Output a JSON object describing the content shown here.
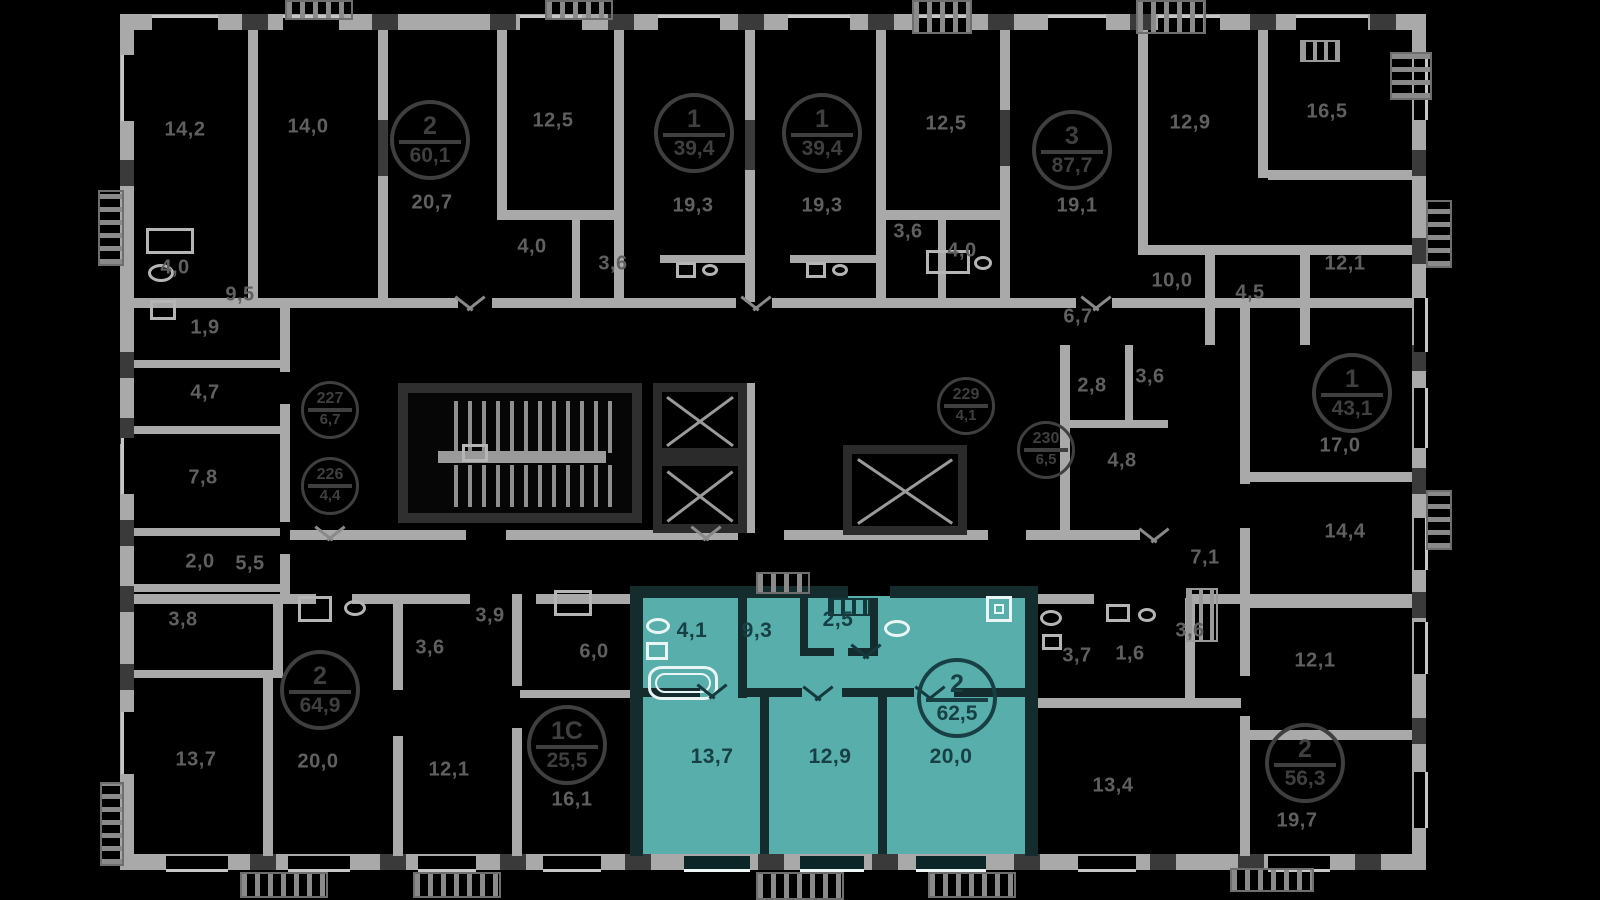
{
  "meta": {
    "view": "residential-building-floor-plan",
    "highlight_note": "one apartment highlighted in teal"
  },
  "colors": {
    "background": "#000000",
    "wall_light": "#a9a9a9",
    "wall_dark": "#3a3a3a",
    "room_label": "#606060",
    "badge_outline": "#3f3f3f",
    "highlight_fill": "#57aeab",
    "highlight_text": "#173f44"
  },
  "selected_apartment": {
    "rooms_count": "2",
    "total_area": "62,5",
    "room_areas": [
      "4,1",
      "9,3",
      "2,5",
      "13,7",
      "12,9",
      "20,0"
    ]
  },
  "apartment_badges": [
    {
      "top": "2",
      "bottom": "60,1",
      "x": 430,
      "y": 140,
      "theme": "dark"
    },
    {
      "top": "1",
      "bottom": "39,4",
      "x": 694,
      "y": 133,
      "theme": "dark"
    },
    {
      "top": "1",
      "bottom": "39,4",
      "x": 822,
      "y": 133,
      "theme": "dark"
    },
    {
      "top": "3",
      "bottom": "87,7",
      "x": 1072,
      "y": 150,
      "theme": "dark"
    },
    {
      "top": "1",
      "bottom": "43,1",
      "x": 1352,
      "y": 393,
      "theme": "dark"
    },
    {
      "top": "2",
      "bottom": "64,9",
      "x": 320,
      "y": 690,
      "theme": "dark"
    },
    {
      "top": "1С",
      "bottom": "25,5",
      "x": 567,
      "y": 745,
      "theme": "dark"
    },
    {
      "top": "2",
      "bottom": "62,5",
      "x": 957,
      "y": 698,
      "theme": "teal"
    },
    {
      "top": "2",
      "bottom": "56,3",
      "x": 1305,
      "y": 763,
      "theme": "dark"
    }
  ],
  "unit_number_badges": [
    {
      "top": "227",
      "bottom": "6,7",
      "x": 330,
      "y": 410
    },
    {
      "top": "226",
      "bottom": "4,4",
      "x": 330,
      "y": 486
    },
    {
      "top": "229",
      "bottom": "4,1",
      "x": 966,
      "y": 406
    },
    {
      "top": "230",
      "bottom": "6,5",
      "x": 1046,
      "y": 450
    }
  ],
  "room_areas": [
    {
      "label": "14,2",
      "x": 185,
      "y": 130
    },
    {
      "label": "14,0",
      "x": 308,
      "y": 127
    },
    {
      "label": "12,5",
      "x": 553,
      "y": 121
    },
    {
      "label": "20,7",
      "x": 432,
      "y": 203
    },
    {
      "label": "4,0",
      "x": 532,
      "y": 247
    },
    {
      "label": "3,6",
      "x": 613,
      "y": 264
    },
    {
      "label": "9,5",
      "x": 240,
      "y": 295
    },
    {
      "label": "4,0",
      "x": 175,
      "y": 268
    },
    {
      "label": "1,9",
      "x": 205,
      "y": 328
    },
    {
      "label": "19,3",
      "x": 693,
      "y": 206
    },
    {
      "label": "19,3",
      "x": 822,
      "y": 206
    },
    {
      "label": "12,5",
      "x": 946,
      "y": 124
    },
    {
      "label": "3,6",
      "x": 908,
      "y": 232
    },
    {
      "label": "4,0",
      "x": 962,
      "y": 251
    },
    {
      "label": "19,1",
      "x": 1077,
      "y": 206
    },
    {
      "label": "6,7",
      "x": 1078,
      "y": 317
    },
    {
      "label": "12,9",
      "x": 1190,
      "y": 123
    },
    {
      "label": "16,5",
      "x": 1327,
      "y": 112
    },
    {
      "label": "10,0",
      "x": 1172,
      "y": 281
    },
    {
      "label": "4,5",
      "x": 1250,
      "y": 293
    },
    {
      "label": "12,1",
      "x": 1345,
      "y": 264
    },
    {
      "label": "4,7",
      "x": 205,
      "y": 393
    },
    {
      "label": "7,8",
      "x": 203,
      "y": 478
    },
    {
      "label": "2,0",
      "x": 200,
      "y": 562
    },
    {
      "label": "5,5",
      "x": 250,
      "y": 564
    },
    {
      "label": "3,8",
      "x": 183,
      "y": 620
    },
    {
      "label": "2,8",
      "x": 1092,
      "y": 386
    },
    {
      "label": "3,6",
      "x": 1150,
      "y": 377
    },
    {
      "label": "4,8",
      "x": 1122,
      "y": 461
    },
    {
      "label": "7,1",
      "x": 1205,
      "y": 558
    },
    {
      "label": "17,0",
      "x": 1340,
      "y": 446
    },
    {
      "label": "14,4",
      "x": 1345,
      "y": 532
    },
    {
      "label": "13,7",
      "x": 196,
      "y": 760
    },
    {
      "label": "20,0",
      "x": 318,
      "y": 762
    },
    {
      "label": "3,6",
      "x": 430,
      "y": 648
    },
    {
      "label": "3,9",
      "x": 490,
      "y": 616
    },
    {
      "label": "12,1",
      "x": 449,
      "y": 770
    },
    {
      "label": "6,0",
      "x": 594,
      "y": 652
    },
    {
      "label": "16,1",
      "x": 572,
      "y": 800
    },
    {
      "label": "3,7",
      "x": 1077,
      "y": 656
    },
    {
      "label": "1,6",
      "x": 1130,
      "y": 654
    },
    {
      "label": "3,6",
      "x": 1190,
      "y": 631
    },
    {
      "label": "12,1",
      "x": 1315,
      "y": 661
    },
    {
      "label": "13,4",
      "x": 1113,
      "y": 786
    },
    {
      "label": "19,7",
      "x": 1297,
      "y": 821
    },
    {
      "label": "4,1",
      "x": 692,
      "y": 631,
      "theme": "teal"
    },
    {
      "label": "9,3",
      "x": 757,
      "y": 631,
      "theme": "teal"
    },
    {
      "label": "2,5",
      "x": 838,
      "y": 620,
      "theme": "teal"
    },
    {
      "label": "13,7",
      "x": 712,
      "y": 757,
      "theme": "teal"
    },
    {
      "label": "12,9",
      "x": 830,
      "y": 757,
      "theme": "teal"
    },
    {
      "label": "20,0",
      "x": 951,
      "y": 757,
      "theme": "teal"
    }
  ]
}
